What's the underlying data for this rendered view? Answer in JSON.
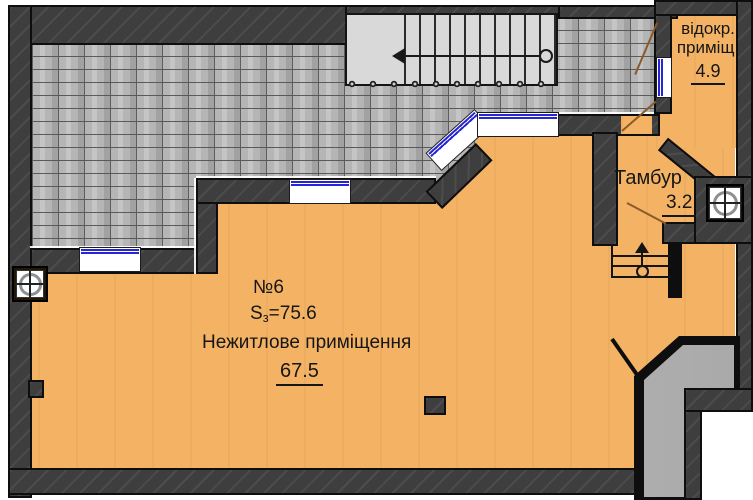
{
  "plan_title": "floor-plan",
  "rooms": {
    "main": {
      "number": "№6",
      "s_prefix": "S",
      "s_sub": "з",
      "s_value": "=75.6",
      "name": "Нежитлове приміщення",
      "area": "67.5"
    },
    "tambur": {
      "name": "Тамбур",
      "area": "3.2"
    },
    "vidokr": {
      "line1": "відокр.",
      "line2": "приміщ.",
      "area": "4.9"
    }
  },
  "colors": {
    "room_fill": "#f4b364",
    "wall": "#3e3e3e",
    "stone": "#b5b5b5",
    "window_blue": "#2626d6",
    "door_brown": "#8a5a2a",
    "stairs": "#d9d9d9",
    "corridor": "#b6b6b6"
  }
}
